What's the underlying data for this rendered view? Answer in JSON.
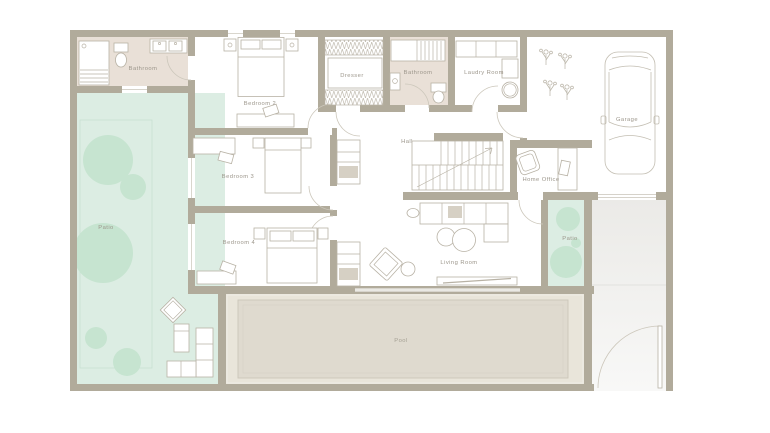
{
  "colors": {
    "wall": "#b1ab9b",
    "bath_floor": "#e9e0d7",
    "patio": "#dcede3",
    "lawn_line": "#c8dfd1",
    "tree": "#c6e4d0",
    "deck": "#e9e5da",
    "pool": "#dfdacf",
    "pool_edge": "#cbc6b9",
    "pool_inner": "#d8d3c7",
    "line": "#b8b2a5",
    "door": "#ccc7bb",
    "label": "#9c968b",
    "label_soft": "#a5a094",
    "drive_dark": "#ebeae7",
    "drive_light": "#f8f8f7",
    "tray": "#d6d0c4",
    "window_line": "#c9c4b8"
  },
  "rooms": {
    "bathroom_1": {
      "label": "Bathroom"
    },
    "bedroom_2": {
      "label": "Bedroom 2"
    },
    "dresser": {
      "label": "Dresser"
    },
    "bathroom_2": {
      "label": "Bathroom"
    },
    "laundry": {
      "label": "Laudry Room"
    },
    "garage": {
      "label": "Garage"
    },
    "hall": {
      "label": "Hall"
    },
    "bedroom_3": {
      "label": "Bedroom 3"
    },
    "home_office": {
      "label": "Home Office"
    },
    "bedroom_4": {
      "label": "Bedroom 4"
    },
    "living_room": {
      "label": "Living Room"
    },
    "patio_left": {
      "label": "Patio"
    },
    "patio_right": {
      "label": "Patio"
    },
    "pool": {
      "label": "Pool"
    }
  }
}
